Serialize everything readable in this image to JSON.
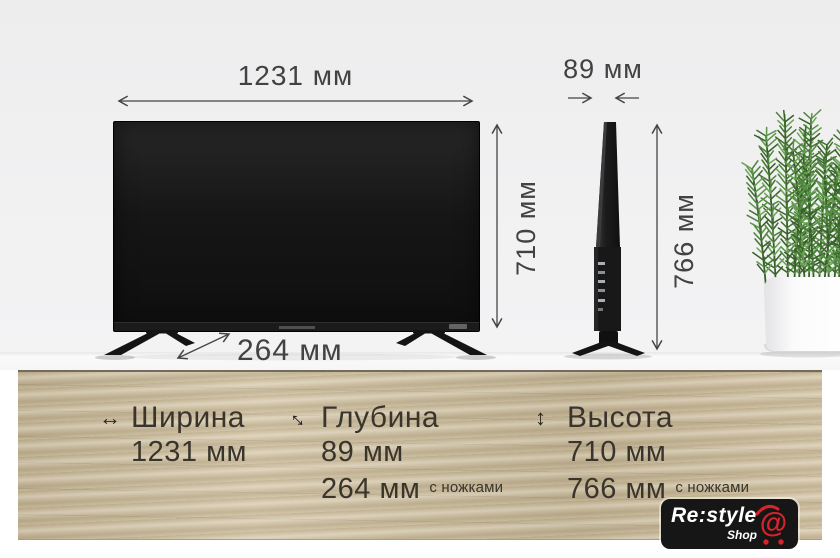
{
  "annotations": {
    "front_width": "1231 мм",
    "front_height": "710 мм",
    "side_depth": "89 мм",
    "side_height": "766 мм",
    "depth_with_stand": "264 мм"
  },
  "info_panel": {
    "columns": [
      {
        "icon": "width-arrows",
        "title": "Ширина",
        "rows": [
          {
            "value": "1231 мм",
            "note": ""
          }
        ]
      },
      {
        "icon": "depth-arrows",
        "title": "Глубина",
        "rows": [
          {
            "value": "89 мм",
            "note": ""
          },
          {
            "value": "264 мм",
            "note": "с ножками"
          }
        ]
      },
      {
        "icon": "height-arrows",
        "title": "Высота",
        "rows": [
          {
            "value": "710 мм",
            "note": ""
          },
          {
            "value": "766 мм",
            "note": "с ножками"
          }
        ]
      }
    ]
  },
  "logo": {
    "brand": "Re:style",
    "sub": "Shop",
    "at": "@"
  },
  "colors": {
    "accent_red": "#d9232a",
    "text_dark": "#3a352c",
    "wood": "#cfc0a0",
    "background": "#f1f1f2"
  }
}
